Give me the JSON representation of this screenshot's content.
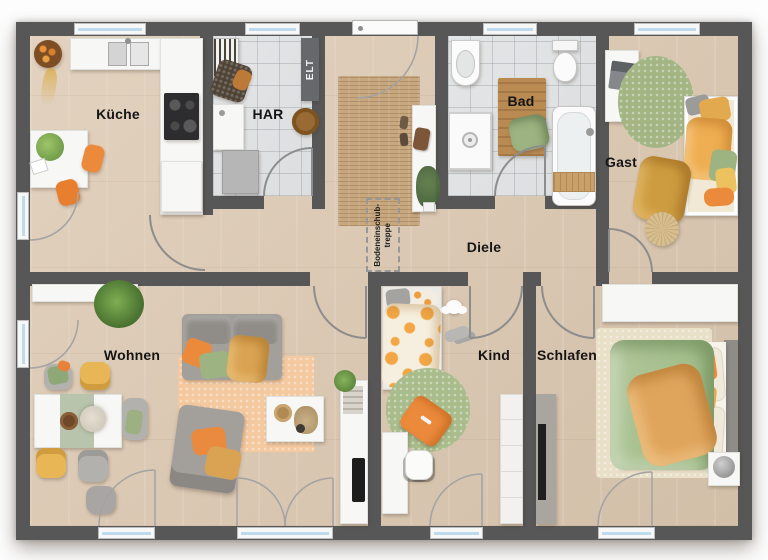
{
  "labels": {
    "kueche": "Küche",
    "har": "HAR",
    "elt": "ELT",
    "bad": "Bad",
    "gast": "Gast",
    "diele": "Diele",
    "wohnen": "Wohnen",
    "kind": "Kind",
    "schlafen": "Schlafen",
    "attic_line1": "Bodeneinschub-",
    "attic_line2": "treppe"
  },
  "colors": {
    "wall": "#575757",
    "floor": "#dbc9b4",
    "tile": "#dcdedf",
    "glass": "#bedbec",
    "jute": "#c7a77e",
    "rug_peach": "#f4c9a0",
    "rug_green": "#a2b583",
    "rug_cream": "#e9e0c8",
    "accent_orange": "#ec8a3c",
    "accent_green": "#9db381",
    "accent_yellow": "#e2a94f",
    "sofa_gray": "#a3a09c",
    "label_text": "#151515"
  }
}
